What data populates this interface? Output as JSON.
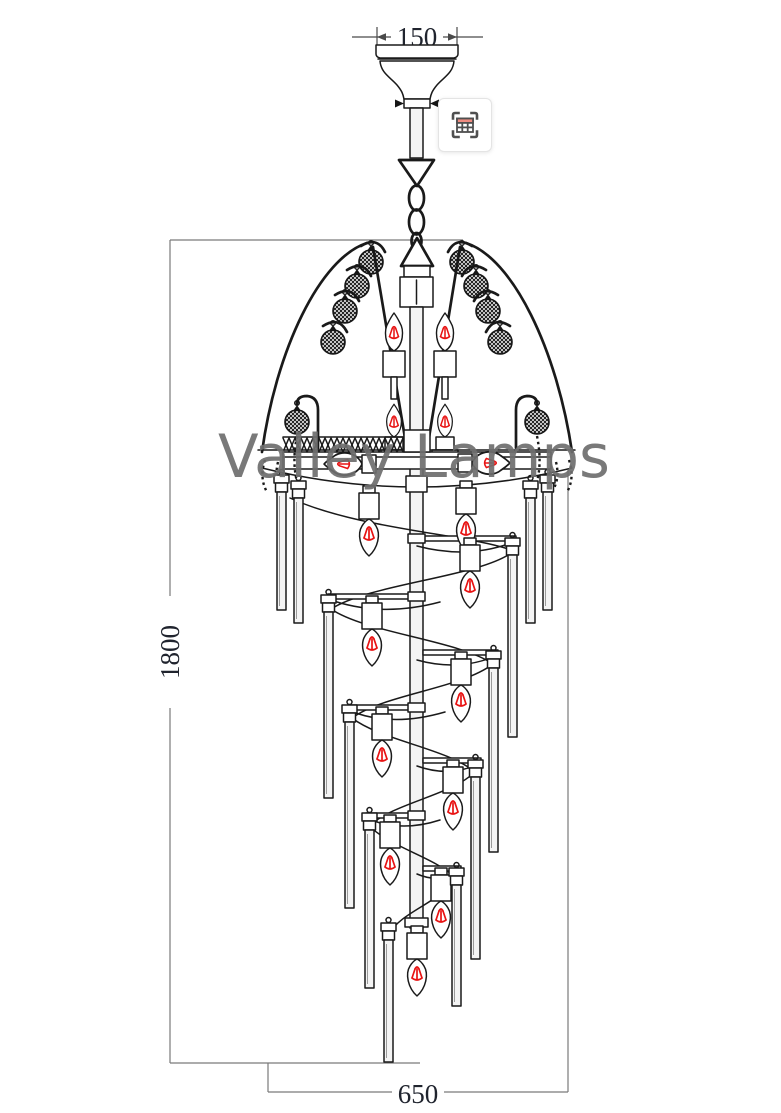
{
  "watermark": {
    "text": "Valley Lamps"
  },
  "dimensions": {
    "canopy_width_label": "150",
    "height_label": "1800",
    "width_label": "650"
  },
  "icon_button": {
    "name": "image-search-table-icon"
  },
  "colors": {
    "background": "#ffffff",
    "drawing_line": "#1a1a1a",
    "dimension_line": "#7a7a7a",
    "dimension_text": "#20242e",
    "filament_red": "#e81313",
    "watermark": "#6e6e6e",
    "icon_frame": "#4f4f4f",
    "icon_accent": "#ef8b80",
    "icon_border": "#e4e4e4"
  }
}
